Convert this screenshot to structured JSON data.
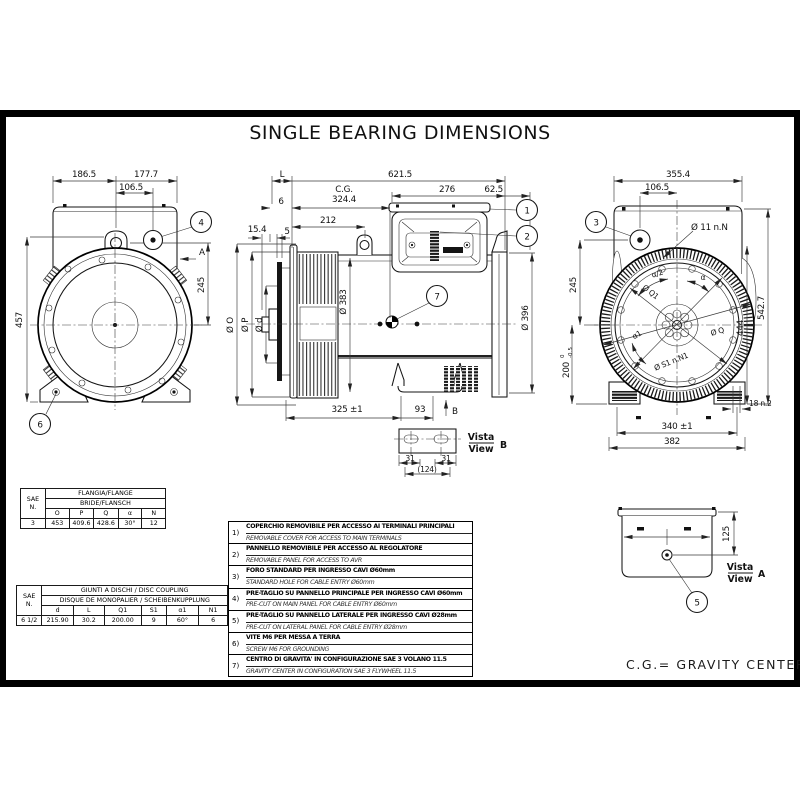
{
  "title": "SINGLE BEARING DIMENSIONS",
  "cg_legend": "C.G.= GRAVITY CENTER",
  "front_view": {
    "dim_186_5": "186.5",
    "dim_177_7": "177.7",
    "dim_106_5": "106.5",
    "dim_457": "457",
    "dim_245": "245",
    "label_a": "A",
    "balloon_4": "4",
    "balloon_6": "6"
  },
  "side_view": {
    "dim_l": "L",
    "dim_621_5": "621.5",
    "dim_276": "276",
    "dim_62_5": "62.5",
    "cg_label": "C.G.",
    "dim_324_4": "324.4",
    "dim_6": "6",
    "dim_212": "212",
    "dim_15_4": "15.4",
    "dim_5": "5",
    "dia_383": "Ø 383",
    "dia_396": "Ø 396",
    "dia_o": "Ø O",
    "dia_p": "Ø P",
    "dia_d": "Ø d",
    "dim_325": "325 ±1",
    "dim_93": "93",
    "label_b": "B",
    "balloon_1": "1",
    "balloon_2": "2",
    "balloon_7": "7"
  },
  "rear_view": {
    "dim_355_4": "355.4",
    "dim_106_5": "106.5",
    "holes_note": "Ø 11  n.N",
    "dim_245": "245",
    "dim_200": "200",
    "tol_hi": "0",
    "tol_lo": "-0.5",
    "alpha_half": "α/2",
    "alpha": "α",
    "alpha_1": "α1",
    "dia_q1": "Ø Q1",
    "dia_q": "Ø Q",
    "dia_s1": "Ø S1  n.N1",
    "dim_444": "444",
    "dim_542_7": "542.7",
    "dim_18": "18  n.2",
    "dim_340": "340 ±1",
    "dim_382": "382",
    "balloon_3": "3"
  },
  "view_b": {
    "vista": "Vista",
    "view": "View",
    "letter": "B",
    "dim_31a": "31",
    "dim_31b": "31",
    "dim_124": "(124)"
  },
  "view_a": {
    "vista": "Vista",
    "view": "View",
    "letter": "A",
    "dim_125": "125",
    "balloon_5": "5"
  },
  "flange_table": {
    "sae_line1": "SAE",
    "sae_line2": "N.",
    "header_it": "FLANGIA/FLANGE",
    "header_fr": "BRIDE/FLANSCH",
    "col_o": "O",
    "col_p": "P",
    "col_q": "Q",
    "col_alpha": "α",
    "col_n": "N",
    "row_sae": "3",
    "val_o": "453",
    "val_p": "409.6",
    "val_q": "428.6",
    "val_alpha": "30°",
    "val_n": "12"
  },
  "coupling_table": {
    "sae_line1": "SAE",
    "sae_line2": "N.",
    "header_en": "GIUNTI  A  DISCHI  /  DISC  COUPLING",
    "header_de": "DISQUE  DE  MONOPALIER  /  SCHEIBENKUPPLUNG",
    "col_d": "d",
    "col_l": "L",
    "col_q1": "Q1",
    "col_s1": "S1",
    "col_alpha1": "α1",
    "col_n1": "N1",
    "row_sae": "6 1/2",
    "val_d": "215.90",
    "val_l": "30.2",
    "val_q1": "200.00",
    "val_s1": "9",
    "val_alpha1": "60°",
    "val_n1": "6"
  },
  "notes": [
    {
      "num": "1)",
      "it": "COPERCHIO REMOVIBILE PER ACCESSO AI TERMINALI PRINCIPALI",
      "en": "REMOVABLE COVER FOR ACCESS TO MAIN TERMINALS"
    },
    {
      "num": "2)",
      "it": "PANNELLO REMOVIBILE PER ACCESSO AL REGOLATORE",
      "en": "REMOVABLE PANEL FOR ACCESS TO AVR"
    },
    {
      "num": "3)",
      "it": "FORO STANDARD PER INGRESSO CAVI Ø60mm",
      "en": "STANDARD HOLE FOR CABLE ENTRY Ø60mm"
    },
    {
      "num": "4)",
      "it": "PRE-TAGLIO SU PANNELLO PRINCIPALE PER INGRESSO CAVI Ø60mm",
      "en": "PRE-CUT ON MAIN PANEL FOR CABLE ENTRY Ø60mm"
    },
    {
      "num": "5)",
      "it": "PRE-TAGLIO SU PANNELLO LATERALE PER INGRESSO CAVI Ø28mm",
      "en": "PRE-CUT ON LATERAL PANEL FOR CABLE ENTRY Ø28mm"
    },
    {
      "num": "6)",
      "it": "VITE M6 PER MESSA A TERRA",
      "en": "SCREW M6 FOR GROUNDING"
    },
    {
      "num": "7)",
      "it": "CENTRO DI GRAVITA' IN CONFIGURAZIONE SAE 3 VOLANO 11.5",
      "en": "GRAVITY CENTER IN CONFIGURATION SAE 3 FLYWHEEL 11.5"
    }
  ]
}
